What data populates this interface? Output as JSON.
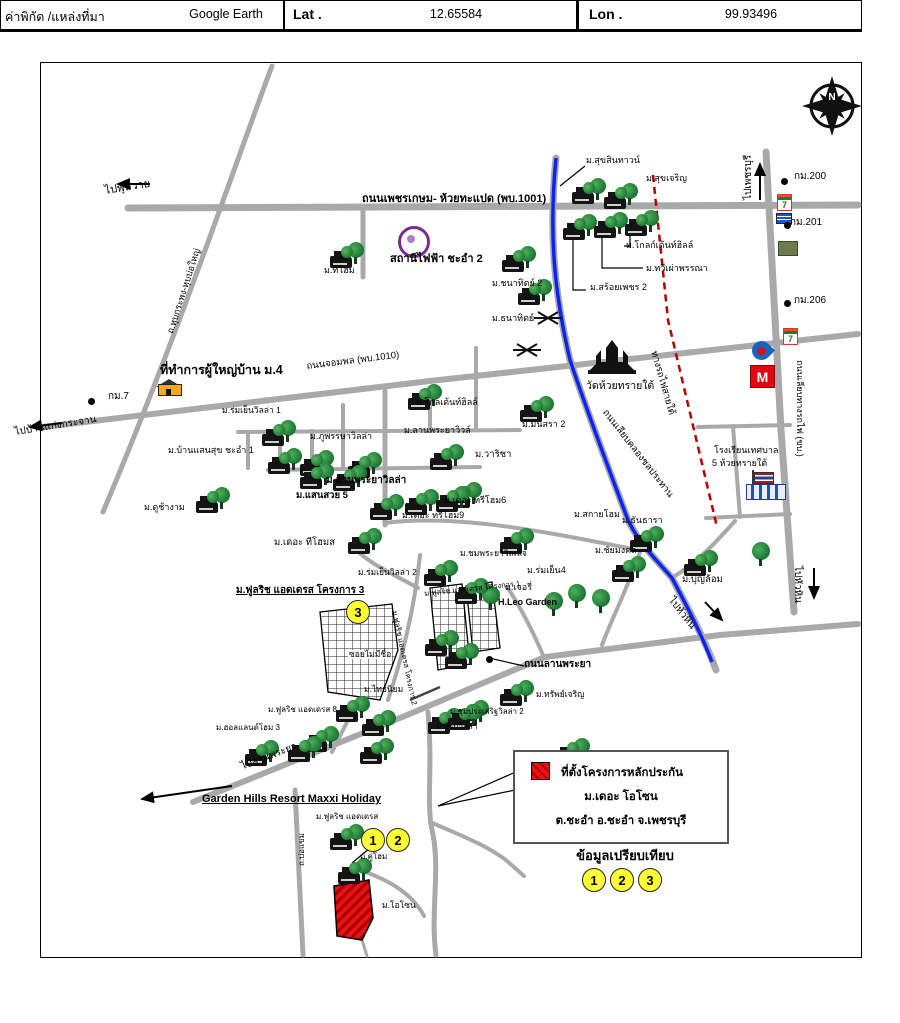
{
  "header": {
    "coord_source_label": "ค่าพิกัด /แหล่งที่มา",
    "source_value": "Google Earth",
    "lat_label": "Lat .",
    "lat_value": "12.65584",
    "lon_label": "Lon .",
    "lon_value": "99.93496"
  },
  "compass": {
    "letter": "N"
  },
  "legend": {
    "title": "ที่ตั้งโครงการหลักประกัน",
    "project_name": "ม.เดอะ โอโซน",
    "address": "ต.ชะอำ อ.ชะอำ จ.เพชรบุรี",
    "compare_title": "ข้อมูลเปรียบเทียบ"
  },
  "colors": {
    "road": "#a9a9a9",
    "canal": "#0b24f5",
    "railway": "#b30000",
    "subject_red": "#ee1111",
    "circle_yellow": "#ffff33",
    "power_purple": "#7b2d8e"
  },
  "labels": [
    {
      "t": "ไปพุหวาย",
      "x": 104,
      "y": 186,
      "r": -9,
      "s": 11,
      "n": "road-label-to-phuwai"
    },
    {
      "t": "ถนนเพชรเกษม- ห้วยทะแปด (พบ.1001)",
      "x": 362,
      "y": 194,
      "s": 11,
      "b": 1,
      "n": "road-label-phetkasem"
    },
    {
      "t": "ม.สุขสินทาวน์",
      "x": 586,
      "y": 156,
      "s": 9
    },
    {
      "t": "ม.สุขเจริญ",
      "x": 646,
      "y": 174,
      "s": 9
    },
    {
      "t": "ม.โกลก์เด้นท์ฮิลล์",
      "x": 626,
      "y": 241,
      "s": 9
    },
    {
      "t": "ม.ทวีเผ่าพรรณา",
      "x": 646,
      "y": 264,
      "s": 9
    },
    {
      "t": "ม.สร้อยเพชร 2",
      "x": 590,
      "y": 283,
      "s": 9
    },
    {
      "t": "ม.ทีโฮม",
      "x": 324,
      "y": 266,
      "s": 9
    },
    {
      "t": "ม.ชนาทิตย์ 2",
      "x": 492,
      "y": 279,
      "s": 9
    },
    {
      "t": "ม.ธนาทิตย์",
      "x": 492,
      "y": 314,
      "s": 9
    },
    {
      "t": "สถานีไฟฟ้า ชะอำ 2",
      "x": 390,
      "y": 254,
      "s": 11,
      "b": 1,
      "n": "power-station-label"
    },
    {
      "t": "ไปเพชรบุรี",
      "x": 744,
      "y": 200,
      "r": -90,
      "s": 10,
      "n": "road-label-to-phetchaburi"
    },
    {
      "t": "กม.200",
      "x": 794,
      "y": 172,
      "s": 10,
      "n": "km-marker-200"
    },
    {
      "t": "กม.201",
      "x": 790,
      "y": 218,
      "s": 10,
      "n": "km-marker-201"
    },
    {
      "t": "กม.206",
      "x": 794,
      "y": 296,
      "s": 10,
      "n": "km-marker-206"
    },
    {
      "t": "ถ.หุบกระพง-หุบบ่อใหญ่",
      "x": 166,
      "y": 332,
      "r": -72,
      "s": 9,
      "n": "road-label-hub-krapong"
    },
    {
      "t": "ที่ทำการผู้ใหญ่บ้าน ม.4",
      "x": 160,
      "y": 364,
      "s": 12.5,
      "b": 1,
      "n": "village-headman-office-label"
    },
    {
      "t": "กม.7",
      "x": 108,
      "y": 392,
      "s": 10,
      "n": "km-marker-7"
    },
    {
      "t": "ไปบ้านแก่งกระจาน",
      "x": 14,
      "y": 428,
      "r": -9,
      "s": 10,
      "n": "road-label-to-kaengkrachan"
    },
    {
      "t": "ถนนจอมพล (พบ.1010)",
      "x": 306,
      "y": 362,
      "r": -7,
      "s": 9.5,
      "n": "road-label-jompon"
    },
    {
      "t": "วัดห้วยทรายใต้",
      "x": 586,
      "y": 381,
      "s": 10.5,
      "n": "temple-label"
    },
    {
      "t": "ถนนเลียบคลองชลประทาน",
      "x": 608,
      "y": 408,
      "r": 52,
      "s": 9.5,
      "n": "road-label-canal-road"
    },
    {
      "t": "ทางรถไฟสายใต้",
      "x": 658,
      "y": 350,
      "r": 74,
      "s": 9.5,
      "n": "railway-label"
    },
    {
      "t": "ถนนเลียบทางรถไฟ (ขบ.)",
      "x": 804,
      "y": 360,
      "r": 90,
      "s": 9,
      "n": "road-label-railway-side"
    },
    {
      "t": "โรงเรียนเทศบาล",
      "x": 714,
      "y": 446,
      "s": 9,
      "n": "school-label-line1"
    },
    {
      "t": "5 ห้วยทรายใต้",
      "x": 712,
      "y": 459,
      "s": 9,
      "n": "school-label-line2"
    },
    {
      "t": "ม.ร่มเย็นวิลล่า 1",
      "x": 222,
      "y": 406,
      "s": 8.5
    },
    {
      "t": "ม.บ้านแสนสุข ชะอำ 1",
      "x": 168,
      "y": 446,
      "s": 9
    },
    {
      "t": "ม.ภูพรรษาวิลล่า",
      "x": 310,
      "y": 432,
      "s": 9
    },
    {
      "t": "ม.โกลเด้นท์ฮิลล์",
      "x": 416,
      "y": 398,
      "s": 9
    },
    {
      "t": "ม.ลานพระยาวิวล์",
      "x": 404,
      "y": 426,
      "s": 9
    },
    {
      "t": "ม.มนัสรา 2",
      "x": 522,
      "y": 420,
      "s": 9
    },
    {
      "t": "ม.วาริชา",
      "x": 475,
      "y": 450,
      "s": 9.5
    },
    {
      "t": "ม.ลานพระยาวิลล่า",
      "x": 326,
      "y": 476,
      "s": 10,
      "b": 1
    },
    {
      "t": "ม.แสนสวย 5",
      "x": 296,
      "y": 491,
      "s": 9.5,
      "b": 1
    },
    {
      "t": "ม.ดูช้างาม",
      "x": 144,
      "y": 503,
      "s": 9
    },
    {
      "t": "ม.เดอะ ทรีโฮม6",
      "x": 444,
      "y": 496,
      "s": 9
    },
    {
      "t": "ม.เดอะ ทรีโฮม9",
      "x": 402,
      "y": 511,
      "s": 9
    },
    {
      "t": "ม.เดอะ ทีโฮมส",
      "x": 274,
      "y": 538,
      "s": 9.5
    },
    {
      "t": "ม.สกายโฮม",
      "x": 574,
      "y": 510,
      "s": 9
    },
    {
      "t": "ม.ชมพระยาวิลเลจ",
      "x": 460,
      "y": 549,
      "s": 8.5
    },
    {
      "t": "ม.ธันธารา",
      "x": 622,
      "y": 516,
      "s": 9
    },
    {
      "t": "ม.ชัยมงคล",
      "x": 595,
      "y": 546,
      "s": 9
    },
    {
      "t": "ม.ร่มเย็น4",
      "x": 527,
      "y": 566,
      "s": 9
    },
    {
      "t": "ม.เจอรี่",
      "x": 505,
      "y": 583,
      "s": 9
    },
    {
      "t": "ม.บุญล้อม",
      "x": 682,
      "y": 575,
      "s": 9.5
    },
    {
      "t": "ม.ร่มเย็นวิลล่า 2",
      "x": 358,
      "y": 568,
      "s": 8.5
    },
    {
      "t": "ม.ฟูลริช แอดเดรส โครงการ 3",
      "x": 236,
      "y": 586,
      "s": 10,
      "b": 1,
      "u": 1
    },
    {
      "t": "H.Leo Garden",
      "x": 498,
      "y": 598,
      "s": 9,
      "b": 1
    },
    {
      "t": "ม.ฟูลริช แอดเดรส โครงการ 1",
      "x": 424,
      "y": 590,
      "r": -6,
      "s": 7.5
    },
    {
      "t": "ม.ฟูลริช แอดเดรส โครงการ 2",
      "x": 398,
      "y": 610,
      "r": 78,
      "s": 7.5
    },
    {
      "t": "ซอยไม่มีชื่อ",
      "x": 348,
      "y": 650,
      "s": 8.5,
      "bg": 1,
      "n": "unnamed-soi-label"
    },
    {
      "t": "ถนนลานพระยา",
      "x": 524,
      "y": 660,
      "s": 10,
      "b": 1,
      "n": "road-label-lanphraya"
    },
    {
      "t": "ม.ไทยนิยม",
      "x": 364,
      "y": 685,
      "s": 8.5
    },
    {
      "t": "ม.ทรัพย์เจริญ",
      "x": 536,
      "y": 690,
      "s": 8.5
    },
    {
      "t": "ม.ชุมประเสริฐวิลล่า 2",
      "x": 450,
      "y": 708,
      "s": 8
    },
    {
      "t": "ม.บ้านวิลล่า",
      "x": 436,
      "y": 723,
      "s": 8
    },
    {
      "t": "ม.ฟูลริช แอดเดรส 8",
      "x": 268,
      "y": 706,
      "s": 8
    },
    {
      "t": "ม.ฮอลแลนด์โฮม 3",
      "x": 216,
      "y": 724,
      "s": 8
    },
    {
      "t": "ไปลานพระยา",
      "x": 240,
      "y": 763,
      "r": -21,
      "s": 10,
      "n": "road-label-to-lanphraya"
    },
    {
      "t": "Garden Hills Resort Maxxi Holiday",
      "x": 202,
      "y": 794,
      "s": 11,
      "b": 1,
      "u": 1,
      "n": "garden-hills-label"
    },
    {
      "t": "ม.ฟูลริช แอดเดรส",
      "x": 316,
      "y": 813,
      "s": 8
    },
    {
      "t": "ม.คู่โฮม",
      "x": 360,
      "y": 853,
      "s": 8
    },
    {
      "t": "ม.โอโซน",
      "x": 382,
      "y": 901,
      "s": 8.5,
      "n": "subject-site-label"
    },
    {
      "t": "ถ.บ่อแขม",
      "x": 298,
      "y": 866,
      "r": -90,
      "s": 8,
      "n": "road-label-bokhaem"
    },
    {
      "t": "ไปหัวหิน",
      "x": 674,
      "y": 596,
      "r": 52,
      "s": 10,
      "n": "road-label-to-huahin-canal"
    },
    {
      "t": "ไปหัวหิน",
      "x": 802,
      "y": 566,
      "r": 90,
      "s": 10,
      "n": "road-label-to-huahin-road"
    }
  ],
  "markers": [
    [
      572,
      178
    ],
    [
      604,
      183
    ],
    [
      563,
      214
    ],
    [
      594,
      212
    ],
    [
      625,
      210
    ],
    [
      330,
      242
    ],
    [
      502,
      246
    ],
    [
      518,
      279
    ],
    [
      262,
      420
    ],
    [
      268,
      448
    ],
    [
      300,
      450
    ],
    [
      408,
      384
    ],
    [
      348,
      452
    ],
    [
      430,
      444
    ],
    [
      520,
      396
    ],
    [
      300,
      463
    ],
    [
      333,
      465
    ],
    [
      370,
      494
    ],
    [
      405,
      489
    ],
    [
      448,
      482
    ],
    [
      436,
      486
    ],
    [
      196,
      487
    ],
    [
      348,
      528
    ],
    [
      424,
      560
    ],
    [
      500,
      528
    ],
    [
      630,
      526
    ],
    [
      612,
      556
    ],
    [
      684,
      550
    ],
    [
      455,
      578
    ],
    [
      425,
      630
    ],
    [
      445,
      643
    ],
    [
      336,
      696
    ],
    [
      500,
      680
    ],
    [
      455,
      700
    ],
    [
      428,
      708
    ],
    [
      305,
      726
    ],
    [
      245,
      740
    ],
    [
      288,
      736
    ],
    [
      362,
      710
    ],
    [
      448,
      704
    ],
    [
      360,
      738
    ],
    [
      556,
      738
    ],
    [
      580,
      764
    ],
    [
      330,
      824
    ],
    [
      338,
      858
    ]
  ],
  "trees": [
    [
      545,
      592
    ],
    [
      568,
      584
    ],
    [
      592,
      589
    ],
    [
      752,
      542
    ],
    [
      482,
      586
    ]
  ],
  "circles": [
    {
      "n": "3",
      "x": 346,
      "y": 600
    },
    {
      "n": "1",
      "x": 361,
      "y": 828
    },
    {
      "n": "2",
      "x": 386,
      "y": 828
    },
    {
      "n": "1",
      "x": 582,
      "y": 868
    },
    {
      "n": "2",
      "x": 610,
      "y": 868
    },
    {
      "n": "3",
      "x": 638,
      "y": 868
    }
  ],
  "dots": [
    [
      781,
      178
    ],
    [
      784,
      222
    ],
    [
      784,
      300
    ],
    [
      88,
      398
    ],
    [
      486,
      656
    ]
  ]
}
